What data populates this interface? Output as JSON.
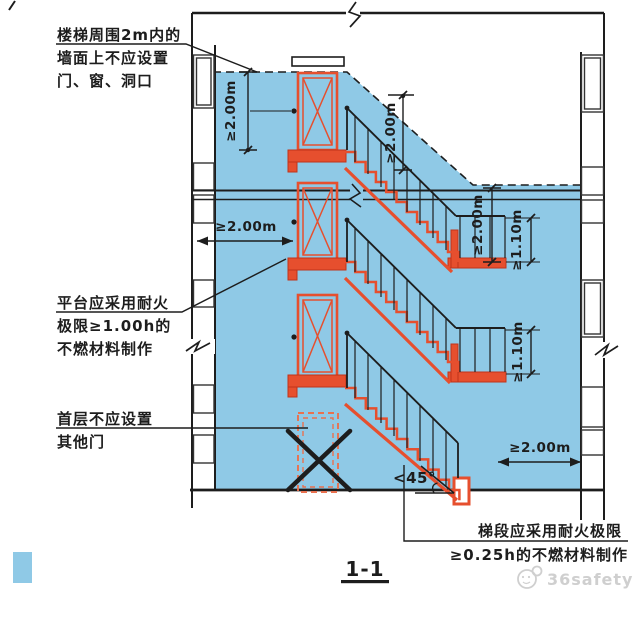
{
  "colors": {
    "zone_blue": "#8FC9E6",
    "stair_red": "#E64F2E",
    "dashed_door_red": "#E8714F",
    "line_black": "#1d1d1d",
    "watermark_gray": "#CFCFCF"
  },
  "annotations": {
    "wall_openings": {
      "line1": "楼梯周围2m内的",
      "line2": "墙面上不应设置",
      "line3": "门、窗、洞口"
    },
    "platform_fire": {
      "line1": "平台应采用耐火",
      "line2": "极限≥1.00h的",
      "line3": "不燃材料制作"
    },
    "first_floor": {
      "line1": "首层不应设置",
      "line2": "其他门"
    },
    "flight_fire": {
      "line1": "梯段应采用耐火极限",
      "line2": "≥0.25h的不燃材料制作"
    }
  },
  "dimensions": {
    "top_left_vertical": "≥2.00m",
    "headroom_vertical": "≥2.00m",
    "mid_left_horizontal": "≥2.00m",
    "right_upper_vertical": "≥2.00m",
    "railing_upper": "≥1.10m",
    "railing_lower": "≥1.10m",
    "bottom_right_horizontal": "≥2.00m",
    "stair_angle": "<45°"
  },
  "section_label": "1-1",
  "watermark": "36safety"
}
